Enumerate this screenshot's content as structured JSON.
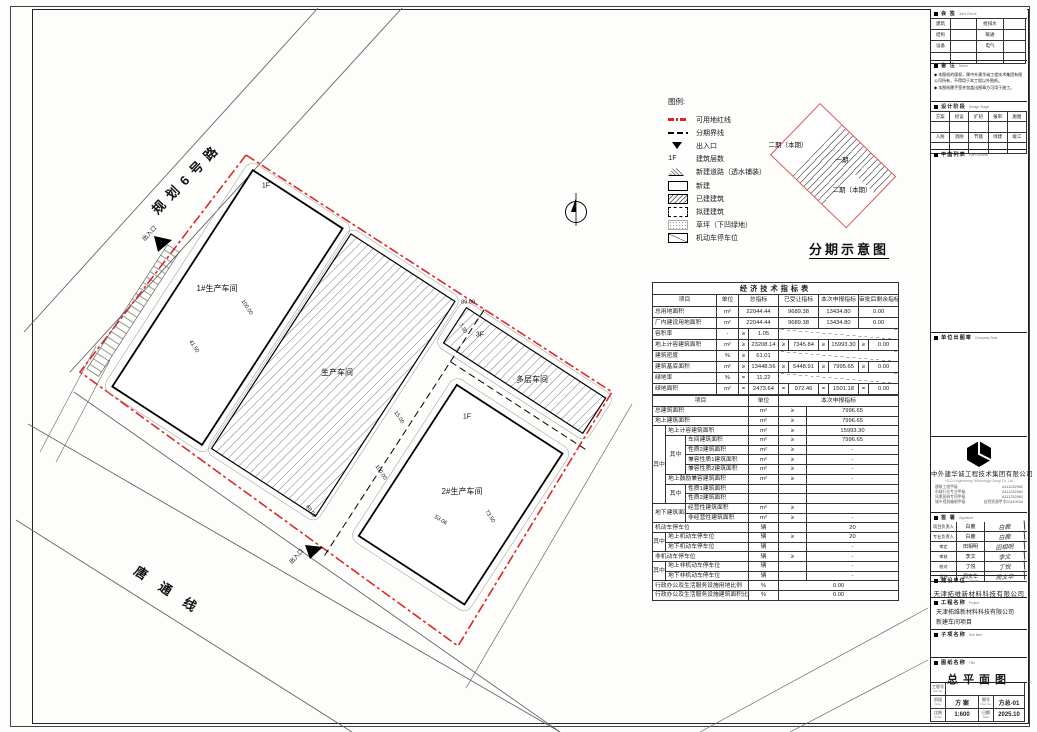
{
  "plan": {
    "road_names": [
      "规划6号路",
      "唐通线"
    ],
    "labels": [
      {
        "t": "规划6号路",
        "x": 187,
        "y": 178,
        "r": -46,
        "s": 13,
        "ls": 7,
        "b": 1,
        "n": "road-label-guihua6"
      },
      {
        "t": "唐通线",
        "x": 172,
        "y": 593,
        "r": 33,
        "s": 13,
        "ls": 16,
        "b": 1,
        "n": "road-label-tangtong"
      },
      {
        "t": "1#生产车间",
        "x": 217,
        "y": 289,
        "r": 0,
        "s": 8,
        "n": "building-label-workshop1"
      },
      {
        "t": "生产车间",
        "x": 337,
        "y": 373,
        "r": 0,
        "s": 8,
        "n": "building-label-workshop-existing"
      },
      {
        "t": "2#生产车间",
        "x": 462,
        "y": 492,
        "r": 0,
        "s": 8,
        "n": "building-label-workshop2"
      },
      {
        "t": "多层车间",
        "x": 532,
        "y": 380,
        "r": 0,
        "s": 8,
        "n": "building-label-multistory"
      },
      {
        "t": "1F",
        "x": 266,
        "y": 186,
        "r": 0,
        "s": 7,
        "n": "floor-label"
      },
      {
        "t": "1F",
        "x": 467,
        "y": 417,
        "r": 0,
        "s": 7,
        "n": "floor-label"
      },
      {
        "t": "3F",
        "x": 480,
        "y": 335,
        "r": 0,
        "s": 7,
        "n": "floor-label"
      },
      {
        "t": "出入口",
        "x": 150,
        "y": 234,
        "r": -47,
        "s": 6,
        "n": "entrance-label"
      },
      {
        "t": "出入口",
        "x": 297,
        "y": 557,
        "r": -47,
        "s": 6,
        "n": "entrance-label"
      },
      {
        "t": "41.50",
        "x": 193,
        "y": 347,
        "r": 57,
        "s": 5.5,
        "n": "dim-label"
      },
      {
        "t": "100.00",
        "x": 246,
        "y": 308,
        "r": 57,
        "s": 5.5,
        "n": "dim-label"
      },
      {
        "t": "15.00",
        "x": 398,
        "y": 418,
        "r": 57,
        "s": 5.5,
        "n": "dim-label"
      },
      {
        "t": "100.00",
        "x": 380,
        "y": 473,
        "r": 57,
        "s": 5.5,
        "n": "dim-label"
      },
      {
        "t": "69.00",
        "x": 310,
        "y": 512,
        "r": 57,
        "s": 5.5,
        "n": "dim-label"
      },
      {
        "t": "53.06",
        "x": 440,
        "y": 521,
        "r": 33,
        "s": 5.5,
        "n": "dim-label"
      },
      {
        "t": "73.50",
        "x": 489,
        "y": 517,
        "r": 57,
        "s": 5.5,
        "n": "dim-label"
      },
      {
        "t": "7.30",
        "x": 462,
        "y": 329,
        "r": 57,
        "s": 5.5,
        "n": "dim-label"
      },
      {
        "t": "89.00",
        "x": 468,
        "y": 303,
        "r": 0,
        "s": 5.5,
        "n": "dim-label"
      }
    ]
  },
  "legend": {
    "title": "图例:",
    "items": [
      {
        "k": "redline",
        "t": "可用地红线"
      },
      {
        "k": "phaseline",
        "t": "分期界线"
      },
      {
        "k": "entrance",
        "t": "出入口"
      },
      {
        "k": "floors",
        "t": "建筑层数",
        "pre": "1F"
      },
      {
        "k": "newroad",
        "t": "新建道路（透水铺装）"
      },
      {
        "k": "newbld",
        "t": "新建"
      },
      {
        "k": "existbld",
        "t": "已建建筑"
      },
      {
        "k": "planbld",
        "t": "拟建建筑"
      },
      {
        "k": "grass",
        "t": "草坪（下凹绿地）"
      },
      {
        "k": "parking",
        "t": "机动车停车位"
      }
    ]
  },
  "phasing": {
    "caption": "分期示意图",
    "labels": [
      {
        "t": "二期（本期）",
        "x": 788,
        "y": 146
      },
      {
        "t": "一期",
        "x": 842,
        "y": 161
      },
      {
        "t": "二期（本期）",
        "x": 852,
        "y": 191
      }
    ]
  },
  "tableA": {
    "cols": [
      64,
      22,
      10,
      30,
      10,
      30,
      10,
      30,
      10,
      30
    ],
    "trs": [
      {
        "h": 12,
        "cells": [
          {
            "t": "经济技术指标表",
            "c": 10,
            "k": "ttl"
          }
        ]
      },
      {
        "h": 12,
        "cells": [
          {
            "t": "项目",
            "k": "hd"
          },
          {
            "t": "单位",
            "k": "hd"
          },
          {
            "t": "总指标",
            "c": 2,
            "k": "hd"
          },
          {
            "t": "已受让指标",
            "c": 2,
            "k": "hd"
          },
          {
            "t": "本次申报指标",
            "c": 2,
            "k": "hd"
          },
          {
            "t": "审批后剩余指标",
            "c": 2,
            "k": "hd"
          }
        ]
      },
      {
        "h": 11,
        "cells": [
          {
            "t": "总用地面积",
            "k": "lbl"
          },
          {
            "t": "m²"
          },
          {
            "t": "22044.44",
            "c": 2
          },
          {
            "t": "9689.38",
            "c": 2
          },
          {
            "t": "13434.80",
            "c": 2
          },
          {
            "t": "0.00",
            "c": 2
          }
        ]
      },
      {
        "h": 11,
        "cells": [
          {
            "t": "厂内建设用地面积",
            "k": "lbl"
          },
          {
            "t": "m²"
          },
          {
            "t": "22044.44",
            "c": 2
          },
          {
            "t": "9689.38",
            "c": 2
          },
          {
            "t": "13434.80",
            "c": 2
          },
          {
            "t": "0.00",
            "c": 2
          }
        ]
      },
      {
        "h": 11,
        "cells": [
          {
            "t": "容积率",
            "k": "lbl"
          },
          {
            "t": "-"
          },
          {
            "t": "≥"
          },
          {
            "t": "1.05"
          },
          {
            "t": "",
            "c": 6,
            "k": "diag"
          }
        ]
      },
      {
        "h": 11,
        "cells": [
          {
            "t": "地上计容建筑面积",
            "k": "lbl"
          },
          {
            "t": "m²"
          },
          {
            "t": "≥"
          },
          {
            "t": "23208.14"
          },
          {
            "t": "≥"
          },
          {
            "t": "7345.84"
          },
          {
            "t": "≥"
          },
          {
            "t": "15993.30"
          },
          {
            "t": "≥"
          },
          {
            "t": "0.00"
          }
        ]
      },
      {
        "h": 11,
        "cells": [
          {
            "t": "建筑密度",
            "k": "lbl"
          },
          {
            "t": "%"
          },
          {
            "t": "≥"
          },
          {
            "t": "61.01"
          },
          {
            "t": "",
            "c": 6,
            "k": "diag"
          }
        ]
      },
      {
        "h": 11,
        "cells": [
          {
            "t": "建筑基底面积",
            "k": "lbl"
          },
          {
            "t": "m²"
          },
          {
            "t": "≥"
          },
          {
            "t": "13448.56"
          },
          {
            "t": "≥"
          },
          {
            "t": "5448.91"
          },
          {
            "t": "≥"
          },
          {
            "t": "7995.65"
          },
          {
            "t": "≥"
          },
          {
            "t": "0.00"
          }
        ]
      },
      {
        "h": 11,
        "cells": [
          {
            "t": "绿地率",
            "k": "lbl"
          },
          {
            "t": "%"
          },
          {
            "t": "="
          },
          {
            "t": "11.22"
          },
          {
            "t": "",
            "c": 6,
            "k": "diag"
          }
        ]
      },
      {
        "h": 11,
        "cells": [
          {
            "t": "绿地面积",
            "k": "lbl"
          },
          {
            "t": "m²"
          },
          {
            "t": "="
          },
          {
            "t": "2473.64"
          },
          {
            "t": "="
          },
          {
            "t": "972.46"
          },
          {
            "t": "="
          },
          {
            "t": "1501.18"
          },
          {
            "t": "="
          },
          {
            "t": "0.00"
          }
        ]
      }
    ]
  },
  "tableB": {
    "cols": [
      13,
      20,
      63,
      30,
      28,
      92
    ],
    "trs": [
      {
        "h": 11,
        "cells": [
          {
            "t": "项目",
            "c": 3,
            "k": "hd"
          },
          {
            "t": "单位",
            "k": "hd"
          },
          {
            "t": "本次申报指标",
            "c": 2,
            "k": "hd"
          }
        ]
      },
      {
        "h": 9.7,
        "cells": [
          {
            "t": "总建筑面积",
            "c": 3,
            "k": "lbl"
          },
          {
            "t": "m²"
          },
          {
            "t": "≥"
          },
          {
            "t": "7996.65"
          }
        ]
      },
      {
        "h": 9.7,
        "cells": [
          {
            "t": "地上建筑面积",
            "c": 3,
            "k": "lbl"
          },
          {
            "t": "m²"
          },
          {
            "t": "≥"
          },
          {
            "t": "7996.65"
          }
        ]
      },
      {
        "h": 9.7,
        "cells": [
          {
            "t": "其中",
            "r": 8
          },
          {
            "t": "地上计容建筑面积",
            "c": 2,
            "k": "lbl"
          },
          {
            "t": "m²"
          },
          {
            "t": "≥"
          },
          {
            "t": "15993.30"
          }
        ]
      },
      {
        "h": 9.7,
        "cells": [
          {
            "t": "其中",
            "r": 4
          },
          {
            "t": "车间建筑面积",
            "k": "lbl"
          },
          {
            "t": "m²"
          },
          {
            "t": "≥"
          },
          {
            "t": "7996.65"
          }
        ]
      },
      {
        "h": 9.7,
        "cells": [
          {
            "t": "性质2建筑面积",
            "k": "lbl"
          },
          {
            "t": "m²"
          },
          {
            "t": "≥"
          },
          {
            "t": "-"
          }
        ]
      },
      {
        "h": 9.7,
        "cells": [
          {
            "t": "兼容性质1建筑面积",
            "k": "lbl"
          },
          {
            "t": "m²"
          },
          {
            "t": "≥"
          },
          {
            "t": "-"
          }
        ]
      },
      {
        "h": 9.7,
        "cells": [
          {
            "t": "兼容性质2建筑面积",
            "k": "lbl"
          },
          {
            "t": "m²"
          },
          {
            "t": "≥"
          },
          {
            "t": "-"
          }
        ]
      },
      {
        "h": 9.7,
        "cells": [
          {
            "t": "地上鼓励兼容建筑面积",
            "c": 2,
            "k": "lbl"
          },
          {
            "t": "m²"
          },
          {
            "t": "≥"
          },
          {
            "t": "-"
          }
        ]
      },
      {
        "h": 9.7,
        "cells": [
          {
            "t": "其中",
            "r": 2
          },
          {
            "t": "性质1建筑面积",
            "k": "lbl"
          },
          {
            "t": ""
          },
          {
            "t": ""
          },
          {
            "t": ""
          }
        ]
      },
      {
        "h": 9.7,
        "cells": [
          {
            "t": "性质2建筑面积",
            "k": "lbl"
          },
          {
            "t": ""
          },
          {
            "t": ""
          },
          {
            "t": ""
          }
        ]
      },
      {
        "h": 9.7,
        "cells": [
          {
            "t": "地下建筑面积",
            "c": 2,
            "r": 2,
            "k": "lbl"
          },
          {
            "t": "经营性建筑面积",
            "k": "lbl"
          },
          {
            "t": "m²"
          },
          {
            "t": "≥"
          },
          {
            "t": ""
          }
        ]
      },
      {
        "h": 9.7,
        "cells": [
          {
            "t": "非经营性建筑面积",
            "k": "lbl"
          },
          {
            "t": "m²"
          },
          {
            "t": "≥"
          },
          {
            "t": "-"
          }
        ]
      },
      {
        "h": 9.7,
        "cells": [
          {
            "t": "机动车停车位",
            "c": 3,
            "k": "lbl"
          },
          {
            "t": "辆"
          },
          {
            "t": ""
          },
          {
            "t": "20"
          }
        ]
      },
      {
        "h": 9.7,
        "cells": [
          {
            "t": "其中",
            "r": 2
          },
          {
            "t": "地上机动车停车位",
            "c": 2,
            "k": "lbl"
          },
          {
            "t": "辆"
          },
          {
            "t": "≥"
          },
          {
            "t": "20"
          }
        ]
      },
      {
        "h": 9.7,
        "cells": [
          {
            "t": "地下机动车停车位",
            "c": 2,
            "k": "lbl"
          },
          {
            "t": "辆"
          },
          {
            "t": ""
          },
          {
            "t": "-"
          }
        ]
      },
      {
        "h": 9.7,
        "cells": [
          {
            "t": "非机动车停车位",
            "c": 3,
            "k": "lbl"
          },
          {
            "t": "辆"
          },
          {
            "t": "≥"
          },
          {
            "t": "-"
          }
        ]
      },
      {
        "h": 9.7,
        "cells": [
          {
            "t": "其中",
            "r": 2
          },
          {
            "t": "地上非机动车停车位",
            "c": 2,
            "k": "lbl"
          },
          {
            "t": "辆"
          },
          {
            "t": ""
          },
          {
            "t": "-"
          }
        ]
      },
      {
        "h": 9.7,
        "cells": [
          {
            "t": "地下非机动车停车位",
            "c": 2,
            "k": "lbl"
          },
          {
            "t": "辆"
          },
          {
            "t": ""
          },
          {
            "t": "-"
          }
        ]
      },
      {
        "h": 9.7,
        "cells": [
          {
            "t": "行政办公及生活服务设施用地比例",
            "c": 3,
            "k": "lbl"
          },
          {
            "t": "%"
          },
          {
            "t": "0.00",
            "c": 2
          }
        ]
      },
      {
        "h": 9.7,
        "cells": [
          {
            "t": "行政办公及生活服务设施建筑面积比例",
            "c": 3,
            "k": "lbl"
          },
          {
            "t": "%"
          },
          {
            "t": "0.00",
            "c": 2
          }
        ]
      }
    ]
  },
  "titleblock": {
    "huiqian": {
      "cn": "会 签",
      "en": "Joint Check",
      "rows": [
        [
          "建筑",
          "给排水"
        ],
        [
          "结构",
          "暖通"
        ],
        [
          "设备",
          "电气"
        ],
        [
          "",
          ""
        ]
      ]
    },
    "notes": {
      "cn": "备 注",
      "en": "Notes",
      "items": [
        "本图纸的版权，属中外建华诚工程技术集团有限公司所有，不得用于本工程以外图纸。",
        "本图纸需手签并加盖出图章方可用于施工。"
      ]
    },
    "stage": {
      "cn": "设计阶段",
      "en": "Design Stage",
      "row1": [
        "方案",
        "初设",
        "扩初",
        "报审",
        "施图"
      ],
      "row2": [
        "人防",
        "消防",
        "节能",
        "绿建",
        "竣工"
      ]
    },
    "planlist": {
      "cn": "平面列表",
      "en": "Plan Number"
    },
    "seal": {
      "cn": "单位出图章",
      "en": "Company Seal"
    },
    "company": {
      "name": "中外建华诚工程技术集团有限公司",
      "en": "HCCI Engineering Technology Group Co.,Ltd",
      "certs": [
        [
          "建筑工程甲级",
          "A111232962"
        ],
        [
          "市政行业专业甲级",
          "A111232962"
        ],
        [
          "风景园林专项甲级",
          "A111232962"
        ],
        [
          "城乡规划编制甲级",
          "自然资源甲字20110024"
        ]
      ]
    },
    "sign": {
      "cn": "签 署",
      "en": "Signature",
      "rows": [
        [
          "项目负责人",
          "白鹿"
        ],
        [
          "专业负责人",
          "白鹿"
        ],
        [
          "审定",
          "田相明"
        ],
        [
          "审核",
          "李文"
        ],
        [
          "校对",
          "丁悦"
        ],
        [
          "设计",
          "周文华"
        ]
      ]
    },
    "owner": {
      "cn": "建设单位",
      "en": "Owner",
      "value": "天津拓维新材料科技有限公司"
    },
    "project": {
      "cn": "工程名称",
      "en": "Project",
      "lines": [
        "天津拓维新材料科技有限公司",
        "新建车间项目"
      ]
    },
    "subitem": {
      "cn": "子项名称",
      "en": "Sub Item",
      "value": ""
    },
    "title": {
      "cn": "图纸名称",
      "en": "Title",
      "value": "总平面图"
    },
    "grid": {
      "job_label": "工程号",
      "job_en": "Job No.",
      "job_value": "",
      "stage_label": "阶段",
      "stage_en": "Stag.",
      "stage_value": "方 案",
      "dwg_label": "图号",
      "dwg_en": "Dwg No.",
      "dwg_value": "方总-01",
      "scale_label": "比例",
      "scale_en": "Scale",
      "scale_value": "1:600",
      "date_label": "日期",
      "date_en": "Date",
      "date_value": "2025.10"
    }
  },
  "colors": {
    "boundary_red": "#d92b2b",
    "phasing_red": "#e05555",
    "line_black": "#1a1a1a"
  }
}
